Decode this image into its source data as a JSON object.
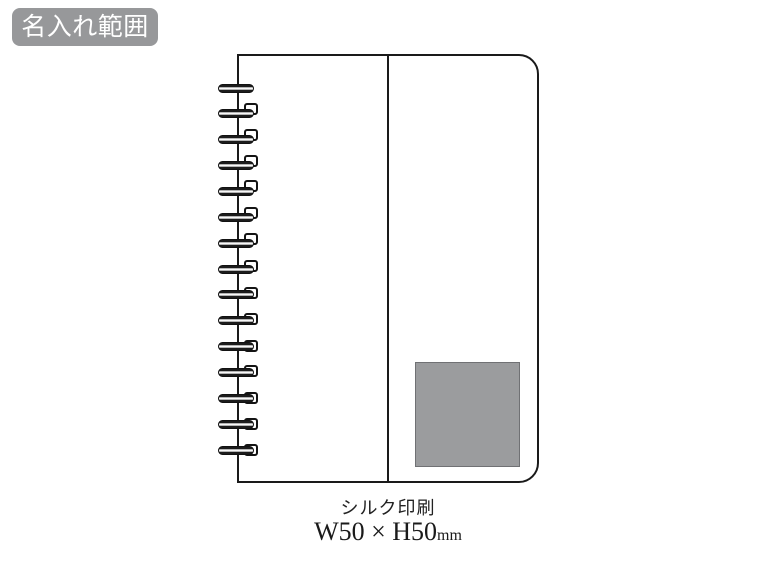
{
  "badge": {
    "text": "名入れ範囲",
    "bg_color": "#97989a",
    "text_color": "#ffffff"
  },
  "notebook": {
    "ring_count": 15,
    "line_color": "#1a1a1a"
  },
  "print_area": {
    "fill_color": "#9b9c9e"
  },
  "caption": {
    "method": "シルク印刷",
    "dimensions": "W50 × H50",
    "unit": "mm"
  }
}
